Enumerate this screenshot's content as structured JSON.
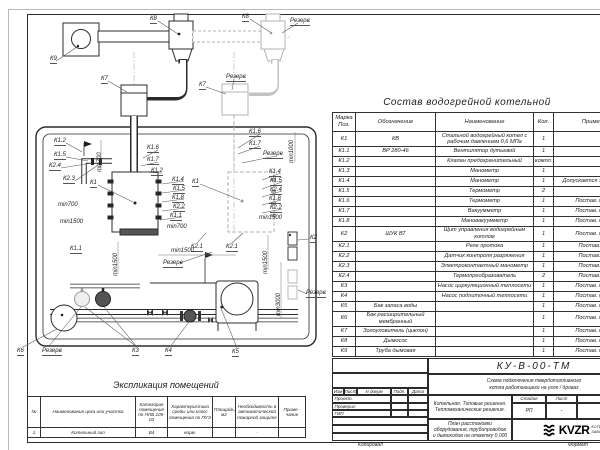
{
  "composition_table": {
    "title": "Состав водогрейной котельной",
    "headers": {
      "mark": "Марка Поз.",
      "designation": "Обозначение",
      "name": "Наименование",
      "qty": "Кол.",
      "note": "Примечание"
    },
    "rows": [
      {
        "mark": "К1",
        "designation": "КВ",
        "name": "Стальной водогрейный котел с рабочим давлением 0,6 МПа",
        "qty": "1",
        "note": ""
      },
      {
        "mark": "К1.1",
        "designation": "ВР 280-46",
        "name": "Вентилятор дутьевой",
        "qty": "1",
        "note": ""
      },
      {
        "mark": "К1.2",
        "designation": "",
        "name": "Клапан предохранительный",
        "qty": "компл.",
        "note": ""
      },
      {
        "mark": "К1.3",
        "designation": "",
        "name": "Манометр",
        "qty": "1",
        "note": ""
      },
      {
        "mark": "К1.4",
        "designation": "",
        "name": "Манометр",
        "qty": "1",
        "note": "Допускается зам. поз. К2.3"
      },
      {
        "mark": "К1.5",
        "designation": "",
        "name": "Термометр",
        "qty": "2",
        "note": ""
      },
      {
        "mark": "К1.6",
        "designation": "",
        "name": "Термометр",
        "qty": "1",
        "note": "Постав. по согла"
      },
      {
        "mark": "К1.7",
        "designation": "",
        "name": "Вакуумметр",
        "qty": "1",
        "note": "Постав. по согла"
      },
      {
        "mark": "К1.8",
        "designation": "",
        "name": "Мановакуумметр",
        "qty": "1",
        "note": "Постав. по согла"
      },
      {
        "mark": "К2",
        "designation": "ШУК ВТ",
        "name": "Щит управления водогрейным котлом",
        "qty": "1",
        "note": "Постав. по согла"
      },
      {
        "mark": "К2.1",
        "designation": "",
        "name": "Реле протока",
        "qty": "1",
        "note": "Постав. с ШУК"
      },
      {
        "mark": "К2.2",
        "designation": "",
        "name": "Датчик контроля разряжения",
        "qty": "1",
        "note": "Постав. с ШУК"
      },
      {
        "mark": "К2.3",
        "designation": "",
        "name": "Электроконтактный манометр",
        "qty": "1",
        "note": "Постав. с ШУК"
      },
      {
        "mark": "К2.4",
        "designation": "",
        "name": "Термопреобразователь",
        "qty": "2",
        "note": "Постав. с ШУК"
      },
      {
        "mark": "К3",
        "designation": "",
        "name": "Насос циркуляционный теплосети",
        "qty": "1",
        "note": "Постав. по согла"
      },
      {
        "mark": "К4",
        "designation": "",
        "name": "Насос подпиточный теплосети",
        "qty": "1",
        "note": "Постав. по согла"
      },
      {
        "mark": "К5",
        "designation": "Бак запаса воды",
        "name": "",
        "qty": "1",
        "note": "Постав. по согла"
      },
      {
        "mark": "К6",
        "designation": "Бак расширительный мембранный",
        "name": "",
        "qty": "1",
        "note": "Постав. по согла"
      },
      {
        "mark": "К7",
        "designation": "Золоуловитель (циклон)",
        "name": "",
        "qty": "1",
        "note": "Постав. по согла"
      },
      {
        "mark": "К8",
        "designation": "Дымосос",
        "name": "",
        "qty": "1",
        "note": "Постав. по согла"
      },
      {
        "mark": "К9",
        "designation": "Труба дымовая",
        "name": "",
        "qty": "1",
        "note": "Постав. по согла"
      }
    ]
  },
  "rooms_table": {
    "title": "Экспликация помещений",
    "headers": [
      "№",
      "Наименование цеха или участка",
      "Категория помещения по НПБ 105-03",
      "Характеристика среды или класс помещения по ПУЭ",
      "Площадь, м2",
      "Необходимость в автоматической пожарной защите",
      "Приме - чание"
    ],
    "rows": [
      [
        "1",
        "Котельный зал",
        "В4",
        "норм.",
        "",
        "-",
        ""
      ]
    ]
  },
  "title_block": {
    "doc_number": "КУ-В-00-ТМ",
    "subtitle_line1": "Схема подключения твердотопливного",
    "subtitle_line2": "котла работающего на угле / дровах",
    "project_line1": "Котельная. Типовые решения.",
    "project_line2": "Тепломеханические решения.",
    "sheet_title": "План расстановки оборудования, трубопроводов и дымоходов на отметку 0,000",
    "rev_headers": [
      "Изм",
      "Лист",
      "N докум",
      "Подп.",
      "Дата"
    ],
    "roles": [
      "Проект.",
      "Проверил",
      "ГИП"
    ],
    "stage_header": "Стадия",
    "sheet_header": "Лист",
    "sheets_header": "Листов",
    "stage": "РП",
    "sheet": "-",
    "sheets": "-",
    "logo_text": "KVZR",
    "company_line1": "КОТЕЛЬН",
    "company_line2": "ЗАВОД Р",
    "copied_label": "Копировал",
    "format_label": "Формат"
  },
  "plan": {
    "labels": [
      {
        "t": "К8",
        "x": 150,
        "y": 16,
        "k": 1
      },
      {
        "t": "К8",
        "x": 242,
        "y": 14,
        "k": 1
      },
      {
        "t": "Резерв",
        "x": 290,
        "y": 18,
        "k": 1
      },
      {
        "t": "К9",
        "x": 50,
        "y": 56,
        "k": 1
      },
      {
        "t": "К7",
        "x": 101,
        "y": 76,
        "k": 1
      },
      {
        "t": "К7",
        "x": 199,
        "y": 82,
        "k": 1
      },
      {
        "t": "Резерв",
        "x": 226,
        "y": 74,
        "k": 1
      },
      {
        "t": "К1.2",
        "x": 54,
        "y": 138,
        "k": 1
      },
      {
        "t": "К1.5",
        "x": 54,
        "y": 152,
        "k": 1
      },
      {
        "t": "К2.4",
        "x": 49,
        "y": 163,
        "k": 1
      },
      {
        "t": "К2.3",
        "x": 63,
        "y": 176,
        "k": 1
      },
      {
        "t": "min700",
        "x": 97,
        "y": 172,
        "v": 1
      },
      {
        "t": "К1.6",
        "x": 147,
        "y": 145,
        "k": 1
      },
      {
        "t": "К1.7",
        "x": 147,
        "y": 157,
        "k": 1
      },
      {
        "t": "К1.2",
        "x": 151,
        "y": 168,
        "k": 1
      },
      {
        "t": "К1.6",
        "x": 249,
        "y": 129,
        "k": 1
      },
      {
        "t": "К1.7",
        "x": 249,
        "y": 141,
        "k": 1
      },
      {
        "t": "Резерв",
        "x": 263,
        "y": 151,
        "k": 1
      },
      {
        "t": "min1000",
        "x": 289,
        "y": 163,
        "v": 1
      },
      {
        "t": "К1",
        "x": 90,
        "y": 180,
        "k": 1
      },
      {
        "t": "К1",
        "x": 192,
        "y": 179,
        "k": 1
      },
      {
        "t": "К1.4",
        "x": 172,
        "y": 177,
        "k": 1
      },
      {
        "t": "К1.5",
        "x": 173,
        "y": 186,
        "k": 1
      },
      {
        "t": "К1.8",
        "x": 172,
        "y": 195,
        "k": 1
      },
      {
        "t": "К2.2",
        "x": 173,
        "y": 204,
        "k": 1
      },
      {
        "t": "К1.1",
        "x": 170,
        "y": 213,
        "k": 1
      },
      {
        "t": "min700",
        "x": 167,
        "y": 224
      },
      {
        "t": "min700",
        "x": 58,
        "y": 202
      },
      {
        "t": "min1500",
        "x": 60,
        "y": 219
      },
      {
        "t": "К1.1",
        "x": 70,
        "y": 246,
        "k": 1
      },
      {
        "t": "К1.4",
        "x": 269,
        "y": 169,
        "k": 1
      },
      {
        "t": "К1.5",
        "x": 270,
        "y": 178,
        "k": 1
      },
      {
        "t": "К2.4",
        "x": 270,
        "y": 187,
        "k": 1
      },
      {
        "t": "К1.8",
        "x": 269,
        "y": 196,
        "k": 1
      },
      {
        "t": "К2.2",
        "x": 270,
        "y": 205,
        "k": 1
      },
      {
        "t": "min1500",
        "x": 259,
        "y": 215
      },
      {
        "t": "К2.1",
        "x": 191,
        "y": 244,
        "k": 1
      },
      {
        "t": "К2.1",
        "x": 226,
        "y": 244,
        "k": 1
      },
      {
        "t": "min1500",
        "x": 171,
        "y": 248
      },
      {
        "t": "Резерв",
        "x": 163,
        "y": 260,
        "k": 1
      },
      {
        "t": "min1500",
        "x": 263,
        "y": 274,
        "v": 1
      },
      {
        "t": "min3000",
        "x": 276,
        "y": 316,
        "v": 1
      },
      {
        "t": "min1500",
        "x": 113,
        "y": 276,
        "v": 1
      },
      {
        "t": "К2",
        "x": 310,
        "y": 235,
        "k": 1
      },
      {
        "t": "Резерв",
        "x": 306,
        "y": 290,
        "k": 1
      },
      {
        "t": "К6",
        "x": 17,
        "y": 348,
        "k": 1
      },
      {
        "t": "Резерв",
        "x": 42,
        "y": 348,
        "k": 1
      },
      {
        "t": "К3",
        "x": 132,
        "y": 348,
        "k": 1
      },
      {
        "t": "К4",
        "x": 165,
        "y": 348,
        "k": 1
      },
      {
        "t": "К5",
        "x": 232,
        "y": 349,
        "k": 1
      }
    ]
  }
}
